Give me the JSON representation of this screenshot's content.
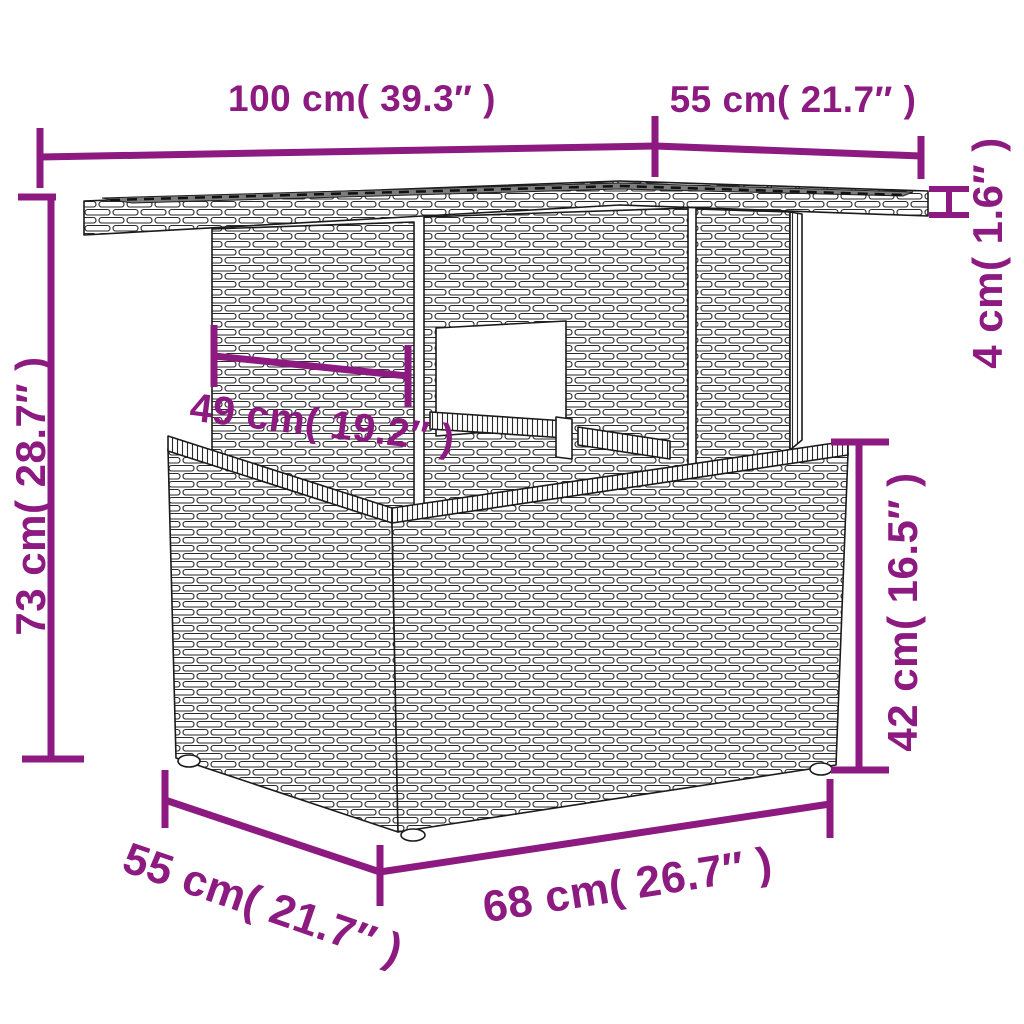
{
  "page": {
    "background": "#ffffff",
    "kind": "product dimension diagram",
    "subject": "poly rattan garden table line drawing"
  },
  "colors": {
    "dimension_accent": "#8C1A80",
    "outline": "#1b1b1b",
    "glass_top": "#7d7d7d",
    "background": "#ffffff"
  },
  "dimensions": {
    "tabletop_length": {
      "label": "100 cm( 39.3″ )",
      "cm": 100,
      "inches": 39.3
    },
    "tabletop_depth": {
      "label": "55 cm( 21.7″ )",
      "cm": 55,
      "inches": 21.7
    },
    "tabletop_thickness": {
      "label": "4 cm( 1.6″ )",
      "cm": 4,
      "inches": 1.6
    },
    "overall_height": {
      "label": "73 cm( 28.7″ )",
      "cm": 73,
      "inches": 28.7
    },
    "pedestal_width": {
      "label": "49 cm( 19.2″ )",
      "cm": 49,
      "inches": 19.2
    },
    "base_height": {
      "label": "42 cm( 16.5″ )",
      "cm": 42,
      "inches": 16.5
    },
    "base_depth": {
      "label": "55 cm( 21.7″ )",
      "cm": 55,
      "inches": 21.7
    },
    "base_length": {
      "label": "68 cm( 26.7″ )",
      "cm": 68,
      "inches": 26.7
    }
  }
}
